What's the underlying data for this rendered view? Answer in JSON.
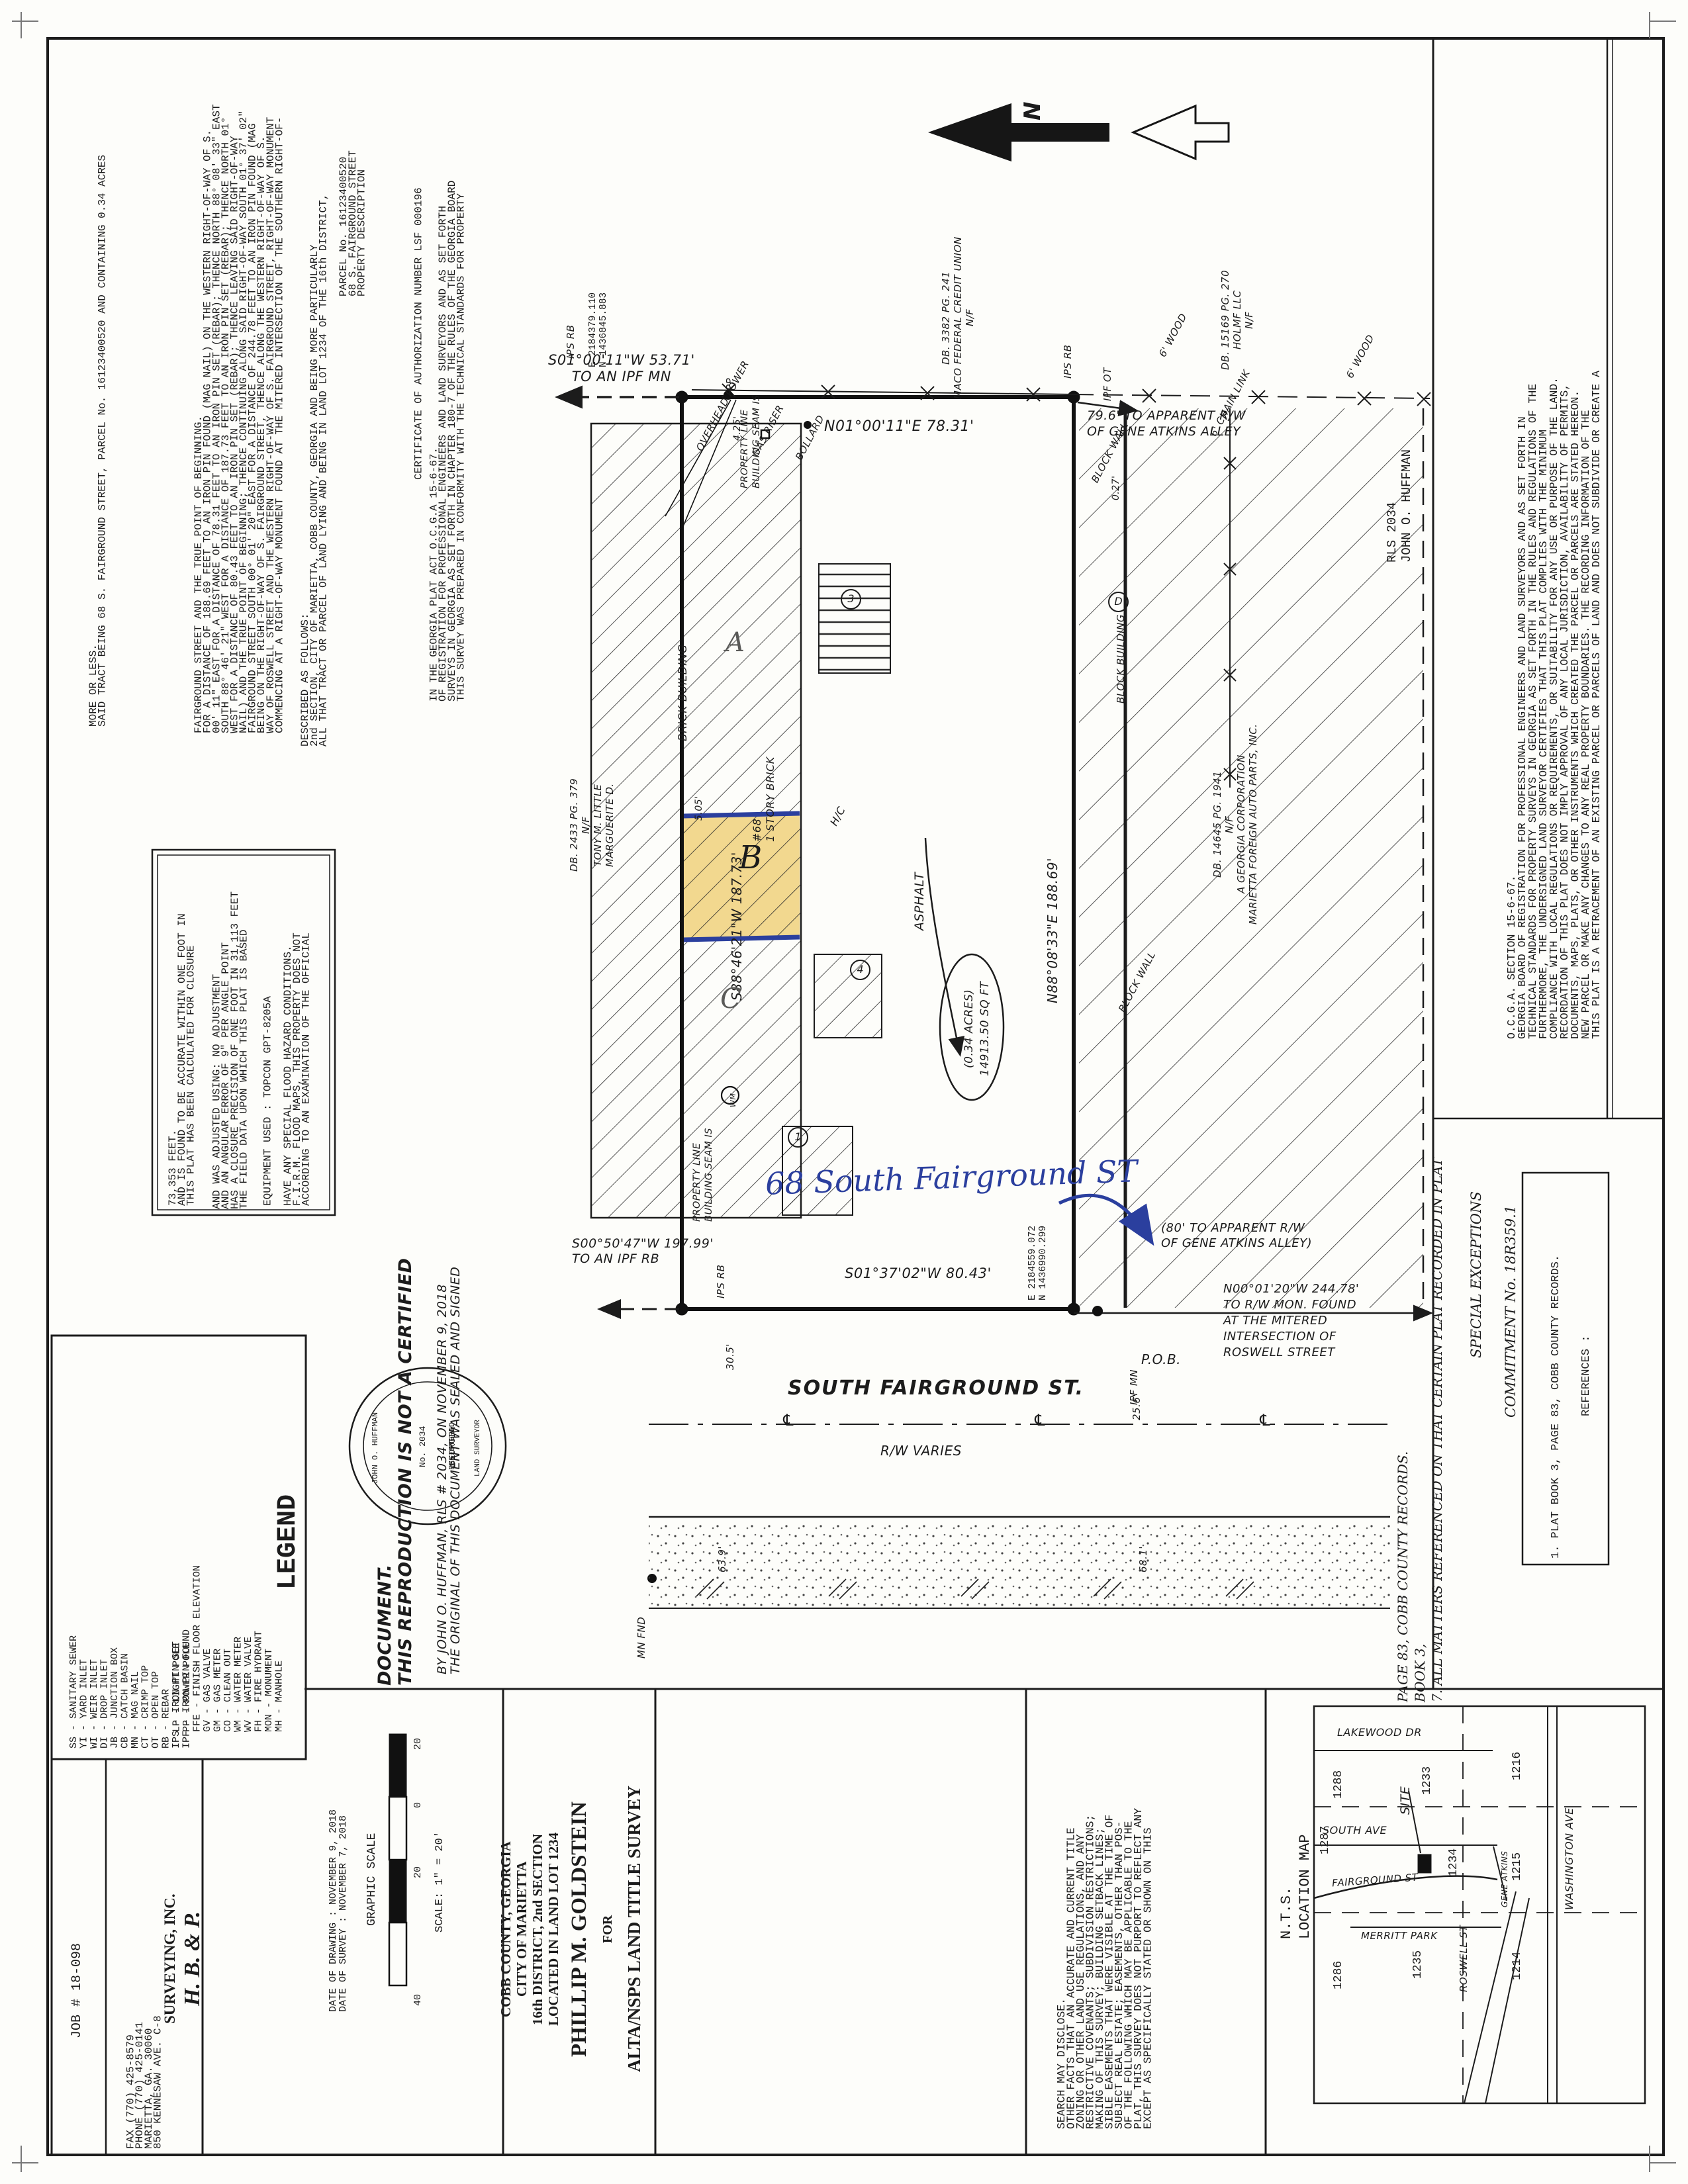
{
  "colors": {
    "paper": "#fdfdfa",
    "ink": "#1c1c1c",
    "highlight_yellow": "#f2d88f",
    "handwriting_blue": "#2b3f9e"
  },
  "sheet": {
    "job_number": "JOB # 18-098"
  },
  "left_notes": {
    "conformity": "THIS SURVEY WAS PREPARED IN CONFORMITY WITH THE TECHNICAL STANDARDS FOR PROPERTY\nSURVEYS IN GEORGIA AS SET FORTH IN CHAPTER 180-7 OF THE RULES OF THE GEORGIA BOARD\nOF REGISTRATION FOR PROFESSIONAL ENGINEERS AND LAND SURVEYORS AND AS SET FORTH\nIN THE GEORGIA PLAT ACT O.C.G.A 15-6-67.",
    "certificate": "CERTIFICATE OF AUTHORIZATION NUMBER LSF 000196",
    "pd_title": "PROPERTY DESCRIPTION\n68 S. FAIRGROUND STREET\nPARCEL No. 16123400520",
    "pd_intro": "ALL THAT TRACT OR PARCEL OF LAND LYING AND BEING IN LAND LOT 1234 OF THE 16th DISTRICT,\n2nd SECTION, CITY OF MARIETTA, COBB COUNTY, GEORGIA AND BEING MORE PARTICULARLY\nDESCRIBED AS FOLLOWS:",
    "pd_body": "COMMENCING AT A RIGHT-OF-WAY MONUMENT FOUND AT THE MITERED INTERSECTION OF THE SOUTHERN RIGHT-OF-WAY OF ROSWELL STREET AND THE WESTERN RIGHT-OF-WAY OF S. FAIRGROUND STREET, RIGHT-OF-WAY MONUMENT BEING ON THE RIGHT-OF-WAY OF S. FAIRGROUND STREET, THENCE ALONG THE WESTERN RIGHT-OF-WAY OF S. FAIRGROUND STREET SOUTH 00° 01' 20\" EAST FOR A DISTANCE OF 244.78 FEET TO AN IRON PIN FOUND (MAG NAIL) AND THE TRUE POINT OF BEGINNING; THENCE CONTINUING ALONG SAID RIGHT-OF-WAY SOUTH 01° 37' 02\" WEST FOR A DISTANCE OF 80.43 FEET TO AN IRON PIN SET (REBAR); THENCE LEAVING SAID RIGHT-OF-WAY SOUTH 88° 46' 21\" WEST FOR A DISTANCE OF 187.73 FEET TO AN IRON PIN SET (REBAR); THENCE NORTH 01° 00' 11\" EAST FOR A DISTANCE OF 78.31 FEET TO AN IRON PIN SET (REBAR); THENCE NORTH 88° 08' 33\" EAST FOR A DISTANCE OF 188.69 FEET TO AN IRON PIN FOUND (MAG NAIL) ON THE WESTERN RIGHT-OF-WAY OF S. FAIRGROUND STREET AND THE TRUE POINT OF BEGINNING.",
    "pd_closing": "SAID TRACT BEING 68 S. FAIRGROUND STREET, PARCEL No. 16123400520 AND CONTAINING 0.34 ACRES\nMORE OR LESS."
  },
  "firm_box": {
    "flood": "ACCORDING TO AN EXAMINATION OF THE OFFICIAL\nF.I.R.M. FLOOD MAPS, THIS PROPERTY DOES NOT\nHAVE ANY SPECIAL FLOOD HAZARD CONDITIONS.",
    "equipment": "EQUIPMENT USED : TOPCON GPT-8205A",
    "field_data": "THE FIELD DATA UPON WHICH THIS PLAT IS BASED\nHAS A CLOSURE PRECISION OF ONE FOOT IN 31,113 FEET\nAND AN ANGULAR ERROR OF 9\" PER ANGLE POINT\nAND WAS ADJUSTED USING: NO ADJUSTMENT",
    "closure": "THIS PLAT HAS BEEN CALCULATED FOR CLOSURE\nAND IS FOUND TO BE ACCURATE WITHIN ONE FOOT IN\n73,353 FEET."
  },
  "certification": {
    "sealed_lines": "THE ORIGINAL OF THIS DOCUMENT WAS SEALED AND SIGNED\nBY JOHN O. HUFFMAN, RLS # 2034, ON NOVEMBER 9, 2018",
    "not_certified": "THIS REPRODUCTION IS NOT A CERTIFIED DOCUMENT.",
    "seal": {
      "state": "GEORGIA",
      "registered": "REGISTERED",
      "number": "No. 2034",
      "name": "JOHN O. HUFFMAN",
      "title": "LAND SURVEYOR"
    }
  },
  "legend": {
    "title": "LEGEND",
    "col1": [
      "MH  -  MANHOLE",
      "MON -  MONUMENT",
      "FH  -  FIRE HYDRANT",
      "WV  -  WATER VALVE",
      "WM  -  WATER METER",
      "CO  -  CLEAN OUT",
      "GM  -  GAS METER",
      "GV  -  GAS VALVE",
      "FFE -  FINISH FLOOR ELEVATION",
      "PP  -  POWER POLE",
      "LP  -  LIGHT POLE"
    ],
    "col2": [
      "IPF -  IRON PIN FOUND",
      "IPS -  IRON PIN SET",
      "RB  -  REBAR",
      "OT  -  OPEN TOP",
      "CT  -  CRIMP TOP",
      "MN  -  MAG NAIL",
      "CB  -  CATCH BASIN",
      "JB  -  JUNCTION BOX",
      "DI  -  DROP INLET",
      "WI  -  WEIR INLET",
      "YI  -  YARD INLET",
      "SS  -  SANITARY SEWER"
    ]
  },
  "hbp": {
    "name1": "H. B. & P.",
    "name2": "SURVEYING, INC.",
    "address": "850 KENNESAW AVE. C-8\nMARIETTA, GA.  30060\nPHONE (770) 425-0141\nFAX     (770) 425-8579"
  },
  "scale_block": {
    "dates": "DATE OF SURVEY : NOVEMBER 7, 2018\nDATE OF DRAWING : NOVEMBER 9, 2018",
    "title": "GRAPHIC SCALE",
    "ticks": [
      "20",
      "0",
      "20",
      "40"
    ],
    "scale": "SCALE: 1\" = 20'"
  },
  "title_block": {
    "line1": "ALTA/NSPS LAND TITLE SURVEY",
    "line2": "FOR",
    "line3": "PHILLIP M. GOLDSTEIN",
    "line4": "LOCATED IN LAND LOT 1234\n16th DISTRICT, 2nd SECTION\nCITY OF MARIETTA\nCOBB COUNTY, GEORGIA"
  },
  "except_note": "EXCEPT AS SPECIFICALLY STATED OR SHOWN ON THIS\nPLAT, THIS SURVEY DOES NOT PURPORT TO REFLECT ANY\nOF THE FOLLOWING WHICH MAY BE APPLICABLE TO THE\nSUBJECT REAL ESTATE; EASEMENTS, OTHER THAN POS-\nSIBLE EASEMENTS THAT WERE VISIBLE AT THE TIME OF\nMAKING OF THIS SURVEY; BUILDING SETBACK LINES;\nRESTRICTIVE COVENANTS; SUBDIVISION RESTRICTIONS;\nZONING OR OTHER LAND USE REGULATIONS, AND ANY\nOTHER FACTS THAT AN ACCURATE AND CURRENT TITLE\nSEARCH MAY DISCLOSE.",
  "right_notes": {
    "retracement": "THIS PLAT IS A RETRACEMENT OF AN EXISTING PARCEL OR PARCELS OF LAND AND DOES NOT SUBDIVIDE OR CREATE A NEW PARCEL OR MAKE ANY CHANGES TO ANY REAL PROPERTY BOUNDARIES. THE RECORDING INFORMATION OF THE DOCUMENTS, MAPS, PLATS, OR OTHER INSTRUMENTS WHICH CREATED THE PARCEL OR PARCELS ARE STATED HEREON. RECORDATION OF THIS PLAT DOES NOT IMPLY APPROVAL OF ANY LOCAL JURISDICTION, AVAILABILITY OF PERMITS, COMPLIANCE WITH LOCAL REGULATIONS OR REQUIREMENTS, OR SUITABILITY FOR ANY USE OR PURPOSE OF THE LAND. FURTHERMORE, THE UNDERSIGNED LAND SURVEYOR CERTIFIES THAT THIS PLAT COMPLIES WITH THE MINIMUM TECHNICAL STANDARDS FOR PROPERTY SURVEYS IN GEORGIA AS SET FORTH IN THE RULES AND REGULATIONS OF THE GEORGIA BOARD OF REGISTRATION FOR PROFESSIONAL ENGINEERS AND LAND SURVEYORS AND AS SET FORTH IN O.C.G.A. SECTION 15-6-67.",
    "surveyor": "JOHN O. HUFFMAN\nRLS 2034",
    "commitment": "COMMITMENT No. 18R359.1",
    "special_exceptions_title": "SPECIAL EXCEPTIONS",
    "special_exception_1": "7. ALL MATTERS REFERENCED ON THAT CERTAIN PLAT RECORDED IN PLAT BOOK 3,\nPAGE 83, COBB COUNTY RECORDS.",
    "references_title": "REFERENCES :",
    "reference_1": "1. PLAT BOOK 3, PAGE 83, COBB COUNTY RECORDS."
  },
  "location_map": {
    "title": "LOCATION MAP\nN.T.S.",
    "site": "SITE",
    "streets": {
      "washington": "WASHINGTON AVE",
      "lakewood": "LAKEWOOD DR",
      "south": "SOUTH AVE",
      "fairground": "FAIRGROUND ST",
      "merritt": "MERRITT PARK",
      "gene": "GENE ATKINS",
      "roswell": "ROSWELL ST"
    },
    "lots": {
      "l1216": "1216",
      "l1215": "1215",
      "l1214": "1214",
      "l1233": "1233",
      "l1234": "1234",
      "l1235": "1235",
      "l1288": "1288",
      "l1287": "1287",
      "l1286": "1286"
    }
  },
  "drawing": {
    "north": "N",
    "bearings": {
      "west_tie": "S01°00'11\"W 53.71'\nTO AN IPF MN",
      "west_line": "N01°00'11\"E   78.31'",
      "north_line": "N88°08'33\"E  188.69'",
      "south_line": "S88°46'21\"W  187.73'",
      "east_line": "S01°37'02\"W  80.43'",
      "south_tie": "S00°50'47\"W 197.99'\nTO AN IPF RB",
      "rw_note": "N00°01'20\"W 244.78'\nTO R/W MON. FOUND\nAT THE MITERED\nINTERSECTION OF\nROSWELL STREET",
      "alley_top": "79.6' TO APPARENT R/W\nOF GENE ATKINS ALLEY",
      "alley_bottom": "(80' TO APPARENT R/W\nOF GENE ATKINS ALLEY)"
    },
    "area": "14913.50 SQ FT\n(0.34 ACRES)",
    "labels": {
      "asphalt": "ASPHALT",
      "brick_building": "BRICK BUILDING",
      "story": "1 STORY BRICK\n#68",
      "seam": "BUILDING SEAM IS\nPROPERTY LINE",
      "overhead": "OVERHEAD POWER",
      "gas_riser": "GAS RISER",
      "bollard": "BOLLARD",
      "pp": "PP",
      "hc": "H/C",
      "block_wall": "BLOCK WALL",
      "block_building": "BLOCK BUILDING",
      "wood_fence": "6' WOOD",
      "chain_fence": "6' CHAIN LINK",
      "street": "SOUTH FAIRGROUND ST.",
      "rw_varies": "R/W VARIES",
      "centerline": "℄"
    },
    "markers": {
      "ips_rb": "IPS RB",
      "ipf_ot": "IPF OT",
      "ipf_mn": "IPF MN",
      "pob": "P.O.B.",
      "mn_fnd": "MN FND",
      "wm": "WM"
    },
    "dims": {
      "d425": "4.25'",
      "d027": "0.27'",
      "d505": "5.05'",
      "d305": "30.5'",
      "d639": "63.9'",
      "d256": "25.6'",
      "d681": "68.1'"
    },
    "coords": {
      "nw": "N 1436845.883\nE 2184379.110",
      "se": "N 1436990.299\nE 2184559.072"
    },
    "neighbors": {
      "maco": "N/F\nMACO FEDERAL CREDIT UNION\nDB. 3382  PG. 241",
      "holmf": "N/F\nHOLMF LLC\nDB. 15169  PG. 270",
      "marietta": "MARIETTA FOREIGN AUTO PARTS, INC.\nA GEORGIA CORPORATION\nN/F\nDB. 14645  PG. 1941",
      "little": "MARGUERITE D.\nTONY M. LITTLE\nN/F\nDB. 2433  PG. 379"
    },
    "annotations": {
      "address_hand": "68 South Fairground ST",
      "a": "A",
      "b": "B",
      "c": "C",
      "n1": "1",
      "n3": "3",
      "n4": "4",
      "nd": "D"
    }
  }
}
